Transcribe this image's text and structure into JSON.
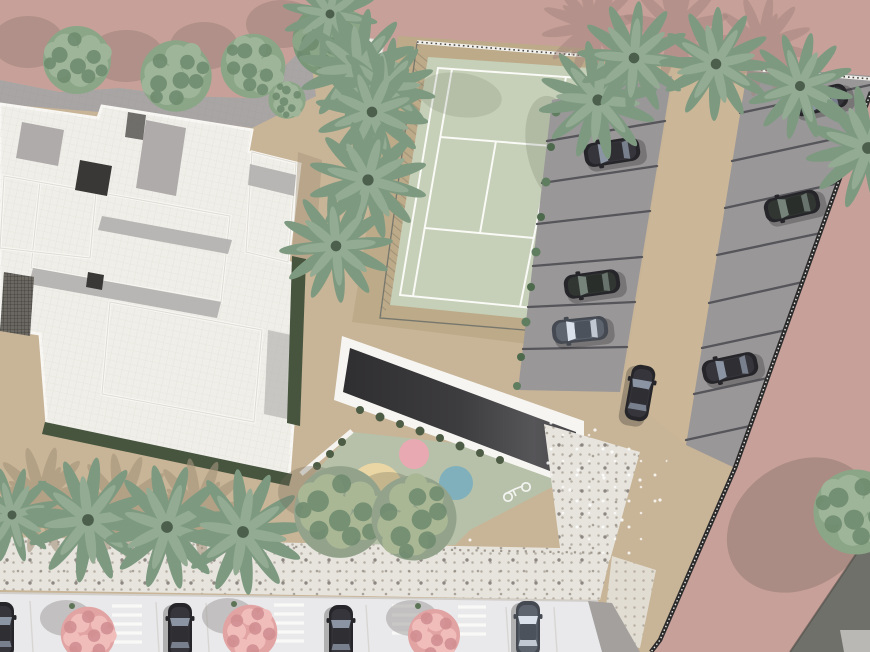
{
  "meta": {
    "view": "aerial-site-plan-rendering",
    "description_elements": [
      "residential-building-roof",
      "tennis-court",
      "surface-parking-lot",
      "entrance-ramp",
      "playground",
      "pedestrian-walkway",
      "street-parking",
      "plaza"
    ]
  },
  "colors": {
    "pinkGround": "#c7a099",
    "shadowMauve": "#a2867e",
    "tanPaving": "#c8b496",
    "tanShadow": "#a6957d",
    "aisleTan": "#cbb797",
    "courtBorder": "#bcaa89",
    "courtGreen": "#c6cfb7",
    "playGreen": "#b7c1a9",
    "roofWhite": "#efeee8",
    "roofBright": "#f8f7f3",
    "roofLine": "#dedcd4",
    "pavingGray": "#a8a5a4",
    "innerShadow": "#b1aeac",
    "darkOpening": "#3a3836",
    "grateGray": "#6b6862",
    "rampDark": "#39383a",
    "grayStall": "#9a9798",
    "stallLine": "#55555a",
    "wallDark": "#2c2b2b",
    "wallLight": "#f2f1ec",
    "hedgeGreen": "#47553f",
    "shrubGreen": "#5f7d5f",
    "treeGreen1": "#8ba687",
    "treeGreen2": "#9fb59a",
    "treeDark": "#6d8a6e",
    "treeDarkBase": "#7a9778",
    "treeOlive": "#93a38b",
    "treeOliveLight": "#aab795",
    "palmGreen1": "#7d9a81",
    "palmGreen2": "#93ab93",
    "palmDark": "#4c5e4c",
    "pinkTree1": "#e2a3a3",
    "pinkTree2": "#f0bdbb",
    "pinkTree3": "#d28f92",
    "streetWhite": "#e9e9eb",
    "curbLine": "#d2cfcb",
    "sidewalkBase": "#e7e4dd",
    "sidewalkDot": "#b5afa5",
    "sidewalkDotDark": "#77716b",
    "stripeWhite": "#f9f9f7",
    "oliveBuilding": "#70706a",
    "cornerGray": "#bab8b5",
    "carDark": "#26262a",
    "carBody2": "#35353b",
    "carGlass": "#8b94a2",
    "carGlassBright": "#dbe1ea",
    "carGlassGreen": "#76837b",
    "carSilver": "#454a52",
    "carSilver2": "#5d646e",
    "carRoof": "#2e2e33",
    "circlePink": "#e8a9b2",
    "circleCream": "#e9d6a4",
    "circleBlue": "#7fb0bc"
  },
  "counts": {
    "parking_cars": 7,
    "street_cars": 4,
    "pink_flowering_trees": 3,
    "round_trees": 9,
    "palm_trees": 15,
    "playground_circles": 3,
    "parking_rows_left": 7,
    "parking_rows_right": 8
  },
  "playground_circles": [
    "pink",
    "cream",
    "blue"
  ]
}
